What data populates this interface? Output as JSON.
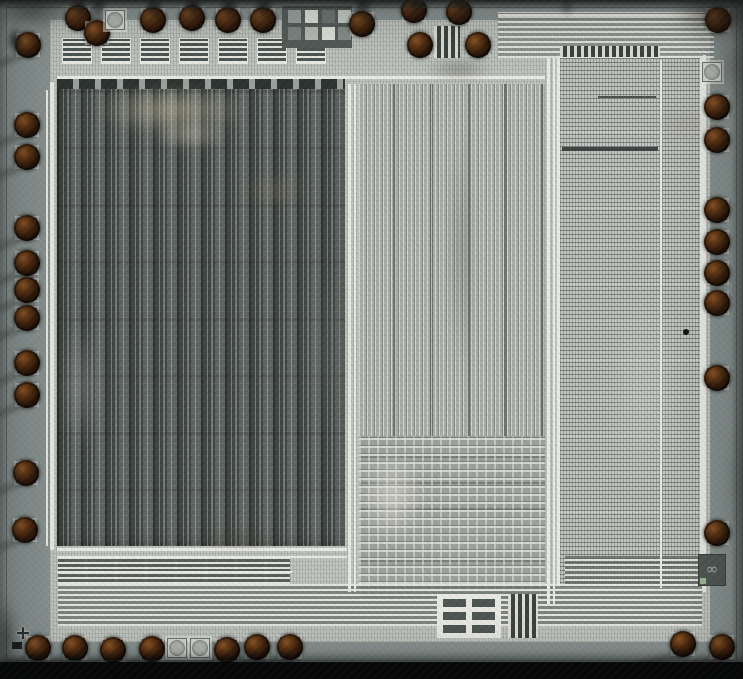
{
  "meta": {
    "description": "Microscope die photograph of an integrated circuit: perimeter bond pads with dark ball bonds and bond-wire shadows, left dark striped logic array, middle light routed logic block, right fine-pitch ROM-like array, top and bottom bus wiring, test-pattern grid top-center, logo mark bottom-right, alignment cross bottom-left, black strip along bottom edge.",
    "width_px": 743,
    "height_px": 679
  },
  "palette": {
    "ring": "#87918f",
    "field": "#c2c6c0",
    "trace": "#e9e9e3",
    "lbase": "#5d6360",
    "mbase": "#a8ada8",
    "rbase": "#c3c7c2",
    "padmetal": "#d3d7d1",
    "ballhi": "#8a5526",
    "ballmid": "#5a3314",
    "balldark": "#140a04",
    "shadow": "rgba(16,14,12,0.55)"
  },
  "scene": {
    "pads": {
      "ball_diameter_px": 26,
      "top": [
        [
          78,
          18
        ],
        [
          97,
          33
        ],
        [
          153,
          20
        ],
        [
          192,
          18
        ],
        [
          228,
          20
        ],
        [
          263,
          20
        ],
        [
          362,
          24
        ],
        [
          414,
          10
        ],
        [
          459,
          12
        ],
        [
          420,
          45
        ],
        [
          478,
          45
        ],
        [
          718,
          20
        ]
      ],
      "left": [
        [
          28,
          45
        ],
        [
          27,
          125
        ],
        [
          27,
          157
        ],
        [
          27,
          228
        ],
        [
          27,
          263
        ],
        [
          27,
          290
        ],
        [
          27,
          318
        ],
        [
          27,
          363
        ],
        [
          27,
          395
        ],
        [
          26,
          473
        ],
        [
          25,
          530
        ]
      ],
      "bottom": [
        [
          38,
          648
        ],
        [
          75,
          648
        ],
        [
          113,
          650
        ],
        [
          152,
          649
        ],
        [
          227,
          650
        ],
        [
          257,
          647
        ],
        [
          290,
          647
        ],
        [
          683,
          644
        ],
        [
          722,
          647
        ]
      ],
      "right": [
        [
          717,
          107
        ],
        [
          717,
          140
        ],
        [
          717,
          210
        ],
        [
          717,
          242
        ],
        [
          717,
          273
        ],
        [
          717,
          303
        ],
        [
          717,
          378
        ],
        [
          717,
          533
        ]
      ],
      "bare": [
        [
          115,
          20
        ],
        [
          712,
          72
        ],
        [
          177,
          648
        ],
        [
          200,
          648
        ]
      ]
    },
    "traces": [
      [
        57,
        76,
        488,
        3
      ],
      [
        50,
        82,
        4,
        468
      ],
      [
        46,
        90,
        2,
        456
      ],
      [
        348,
        84,
        3,
        508
      ],
      [
        354,
        84,
        2,
        508
      ],
      [
        547,
        58,
        3,
        546
      ],
      [
        553,
        58,
        2,
        546
      ],
      [
        703,
        55,
        3,
        537
      ],
      [
        660,
        60,
        2,
        528
      ],
      [
        57,
        548,
        290,
        3
      ],
      [
        57,
        556,
        290,
        2
      ],
      [
        57,
        571,
        235,
        2
      ],
      [
        498,
        14,
        216,
        2
      ],
      [
        498,
        21,
        216,
        2
      ],
      [
        562,
        147,
        96,
        4,
        "#3e4442"
      ],
      [
        598,
        96,
        58,
        2,
        "#4a504d"
      ]
    ],
    "ladders": [
      {
        "x": 62,
        "y": 38,
        "w": 30,
        "h": 26,
        "pitch": 39,
        "count": 7
      }
    ],
    "finebars": [
      [
        560,
        46,
        100,
        11
      ],
      [
        434,
        26,
        26,
        32
      ],
      [
        508,
        594,
        30,
        44
      ]
    ],
    "test_pattern": {
      "patch": [
        282,
        6,
        70,
        42,
        "#545c59"
      ],
      "square_size": 13,
      "squares": [
        [
          288,
          10,
          "#9aa29e"
        ],
        [
          305,
          10,
          "#dfe1db"
        ],
        [
          322,
          10,
          "#6e7672"
        ],
        [
          338,
          10,
          "#c8ccc6"
        ],
        [
          288,
          27,
          "#7e8682"
        ],
        [
          305,
          27,
          "#b8bcb6"
        ],
        [
          322,
          27,
          "#dfe1db"
        ],
        [
          338,
          27,
          "#868e8a"
        ]
      ]
    },
    "grid_structure": {
      "x": 437,
      "y": 594,
      "w": 64,
      "h": 44,
      "cols": 2,
      "rows": 3
    },
    "marks": {
      "logo": {
        "x": 698,
        "y": 554,
        "w": 28,
        "h": 32,
        "glyph": "∞"
      },
      "logo_chip": {
        "x": 700,
        "y": 578,
        "w": 6,
        "h": 6
      },
      "cross": {
        "x": 15,
        "y": 626,
        "glyph": "+"
      },
      "dark_chip": {
        "x": 12,
        "y": 642,
        "w": 10,
        "h": 7
      },
      "defect_dot": {
        "x": 683,
        "y": 329
      }
    },
    "stains": [
      [
        92,
        86,
        160,
        48,
        "#d8cbaa",
        0.5,
        6
      ],
      [
        150,
        120,
        80,
        30,
        "#e6ddc4",
        0.4,
        5
      ],
      [
        240,
        172,
        72,
        36,
        "#8a7a5e",
        0.3,
        5
      ],
      [
        58,
        320,
        46,
        130,
        "#b6bab4",
        0.3,
        6
      ],
      [
        300,
        250,
        50,
        200,
        "#6a706c",
        0.25,
        8
      ],
      [
        448,
        120,
        26,
        260,
        "#4e5450",
        0.35,
        6
      ],
      [
        360,
        448,
        64,
        96,
        "#e4e2d8",
        0.55,
        5
      ],
      [
        196,
        526,
        86,
        24,
        "#4a4034",
        0.3,
        4
      ],
      [
        424,
        56,
        70,
        26,
        "#332e26",
        0.3,
        4
      ],
      [
        604,
        280,
        80,
        220,
        "#d8dcd6",
        0.25,
        9
      ],
      [
        648,
        108,
        70,
        34,
        "#90887a",
        0.3,
        5
      ]
    ],
    "corner_blobs": [
      [
        672,
        -18,
        110,
        58,
        "#241a12",
        0.8,
        9
      ],
      [
        718,
        30,
        30,
        70,
        "#2a211a",
        0.4,
        8
      ],
      [
        -14,
        -10,
        90,
        36,
        "#101210",
        0.65,
        8
      ],
      [
        6,
        26,
        18,
        28,
        "#181c1a",
        0.85,
        2
      ],
      [
        -8,
        596,
        24,
        86,
        "#0c0e0c",
        0.7,
        6
      ],
      [
        560,
        -4,
        14,
        20,
        "#202422",
        0.6,
        3
      ],
      [
        320,
        -4,
        120,
        12,
        "#202422",
        0.5,
        4
      ],
      [
        728,
        420,
        16,
        120,
        "#3a4442",
        0.3,
        6
      ]
    ],
    "top_smudge_xs": [
      78,
      97,
      153,
      192,
      228,
      263,
      362,
      414,
      459
    ],
    "wire_shadows": {
      "bottom": {
        "len": 82,
        "angle": -16,
        "w": 9,
        "opacity": 0.5
      },
      "left": {
        "len": 40,
        "angle": -22,
        "w": 8,
        "opacity": 0.45
      }
    }
  }
}
